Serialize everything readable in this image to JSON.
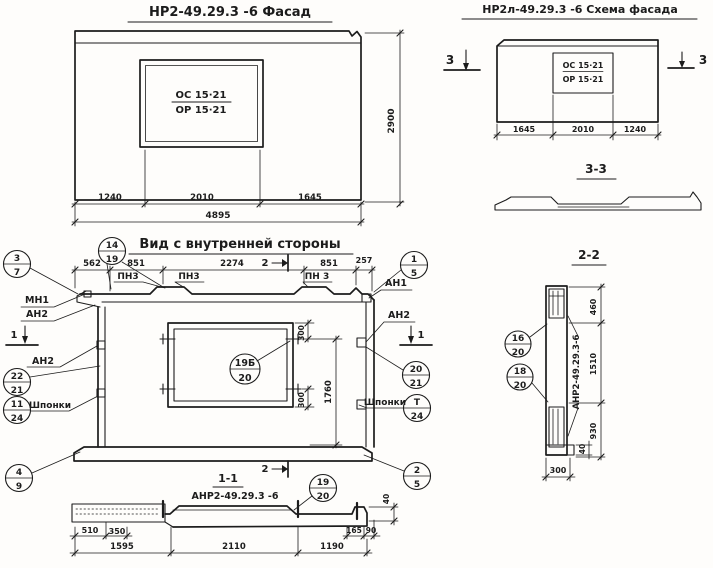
{
  "ink": "#1c1c1c",
  "facade": {
    "title": "НР2-49.29.3 -6  Фасад",
    "window_top": "ОС 15·21",
    "window_bottom": "ОР 15·21",
    "dim_left": "1240",
    "dim_mid": "2010",
    "dim_right": "1645",
    "dim_total": "4895",
    "dim_height": "2900"
  },
  "schema": {
    "title": "НР2л-49.29.3 -6 Схема фасада",
    "window_top": "ОС 15·21",
    "window_bottom": "ОР 15·21",
    "dim_left": "1645",
    "dim_mid": "2010",
    "dim_right": "1240",
    "mark_left": "3",
    "mark_right": "3"
  },
  "section33": {
    "title": "3-3"
  },
  "inner": {
    "title": "Вид с внутренней стороны",
    "dims_top": [
      "562",
      "851",
      "2274",
      "851",
      "257"
    ],
    "dim_300_top": "300",
    "dim_300_bottom": "300",
    "dim_1760": "1760",
    "labels": {
      "pn3_a": "ПН3",
      "pn3_b": "ПН3",
      "pn3_c": "ПН 3",
      "mn1": "МН1",
      "an2_left_top": "АН2",
      "an2_left": "АН2",
      "an1": "АН1",
      "an2_right": "АН2",
      "shponki_left": "Шпонки",
      "shponki_right": "Шпонки"
    },
    "marks": {
      "s1_left": "1",
      "s1_right": "1",
      "s2_top": "2",
      "s2_bottom": "2"
    },
    "balloons": {
      "b3_7": {
        "top": "3",
        "bottom": "7"
      },
      "b14_19": {
        "top": "14",
        "bottom": "19"
      },
      "b1_5": {
        "top": "1",
        "bottom": "5"
      },
      "b22_21": {
        "top": "22",
        "bottom": "21"
      },
      "b11_24": {
        "top": "11",
        "bottom": "24"
      },
      "b4_9": {
        "top": "4",
        "bottom": "9"
      },
      "b20_21": {
        "top": "20",
        "bottom": "21"
      },
      "bT_24": {
        "top": "Т",
        "bottom": "24"
      },
      "b2_5": {
        "top": "2",
        "bottom": "5"
      },
      "b19b_20": {
        "top": "19Б",
        "bottom": "20"
      }
    }
  },
  "section11": {
    "title": "1-1",
    "label": "АНР2-49.29.3 -6",
    "balloon": {
      "top": "19",
      "bottom": "20"
    },
    "dims": {
      "d510": "510",
      "d350": "350",
      "d1595": "1595",
      "d2110": "2110",
      "d1190": "1190",
      "d165": "165",
      "d90": "90",
      "d40": "40"
    }
  },
  "section22": {
    "title": "2-2",
    "label_vertical": "АНР2-49.29.3-6",
    "balloons": {
      "b16_20": {
        "top": "16",
        "bottom": "20"
      },
      "b18_20": {
        "top": "18",
        "bottom": "20"
      }
    },
    "dims": {
      "d460": "460",
      "d1510": "1510",
      "d930": "930",
      "d300": "300",
      "d40": "40"
    }
  }
}
